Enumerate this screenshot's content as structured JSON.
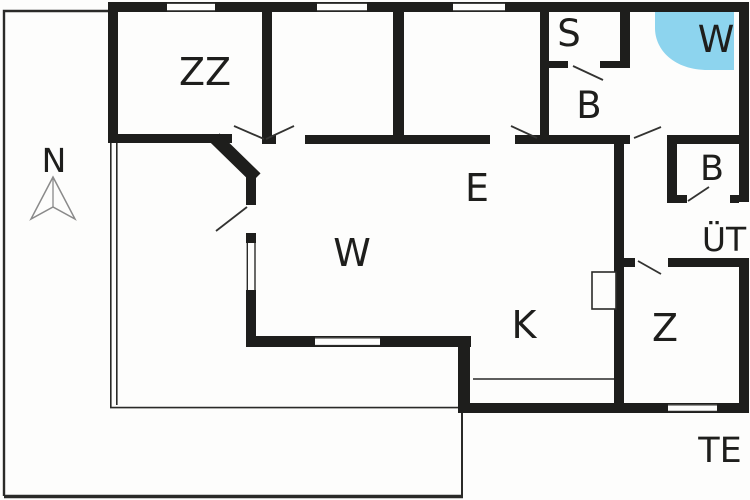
{
  "plan": {
    "type": "holiday-house-floor-plan",
    "compass": {
      "label": "N"
    },
    "colors": {
      "wall": "#1e1e1c",
      "tub": "#8dd4ee",
      "thin_line": "#2a2a28",
      "compass_stroke": "#8a8a8a",
      "background": "#fdfdfc"
    },
    "rooms": [
      {
        "id": "bedroom-zz",
        "label": "ZZ"
      },
      {
        "id": "sauna",
        "label": "S"
      },
      {
        "id": "whirlpool",
        "label": "W"
      },
      {
        "id": "bathroom",
        "label": "B"
      },
      {
        "id": "wc",
        "label": "B"
      },
      {
        "id": "covered-terrace",
        "label": "ÜT"
      },
      {
        "id": "entry",
        "label": "E"
      },
      {
        "id": "living-room",
        "label": "W"
      },
      {
        "id": "kitchen",
        "label": "K"
      },
      {
        "id": "room-z",
        "label": "Z"
      },
      {
        "id": "terrace",
        "label": "TE"
      }
    ]
  }
}
